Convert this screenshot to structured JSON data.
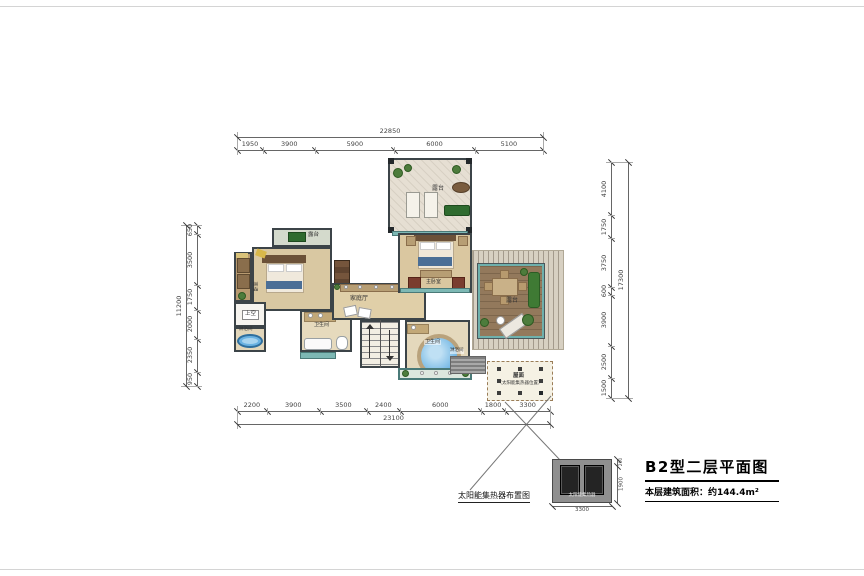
{
  "title_block": {
    "title": "B2型二层平面图",
    "area_line": "本层建筑面积：约144.4m²"
  },
  "solar_layout_label": "太阳能集热器布置图",
  "detail": {
    "caption": "太阳能集热器",
    "dims": {
      "width": "3300",
      "height": "1900",
      "top": "200"
    }
  },
  "rooms": {
    "terrace_top": "露台",
    "balcony_top_left": "露台",
    "bedroom_left": "卧室",
    "void_space": "上空",
    "shower_left": "淋浴间",
    "bath_left": "卫生间",
    "family_hall": "家庭厅",
    "master_bedroom": "主卧室",
    "bath_center": "卫生间",
    "shower_center": "淋浴间",
    "terrace_right": "露台",
    "roof": "屋面",
    "roof_note": "（太阳能集热器位置）"
  },
  "dims": {
    "top": {
      "total": "22850",
      "segments": [
        "1950",
        "3900",
        "5900",
        "6000",
        "5100"
      ]
    },
    "bottom": {
      "total": "23100",
      "segments": [
        "2200",
        "3900",
        "3500",
        "2400",
        "6000",
        "1800",
        "3300"
      ]
    },
    "left": {
      "total": "11200",
      "segments": [
        "650",
        "3500",
        "1750",
        "2000",
        "2350",
        "950"
      ]
    },
    "right": {
      "total": "17300",
      "segments": [
        "4100",
        "1750",
        "3750",
        "600",
        "3900",
        "2500",
        "1500"
      ]
    }
  },
  "colors": {
    "wall": "#3c4448",
    "floor": "#dcc9a0",
    "glass": "#7db8b4",
    "deck": "#93795c",
    "water": "#6ab2e2",
    "plant": "#4d7c3c",
    "dim_line": "#666666"
  }
}
